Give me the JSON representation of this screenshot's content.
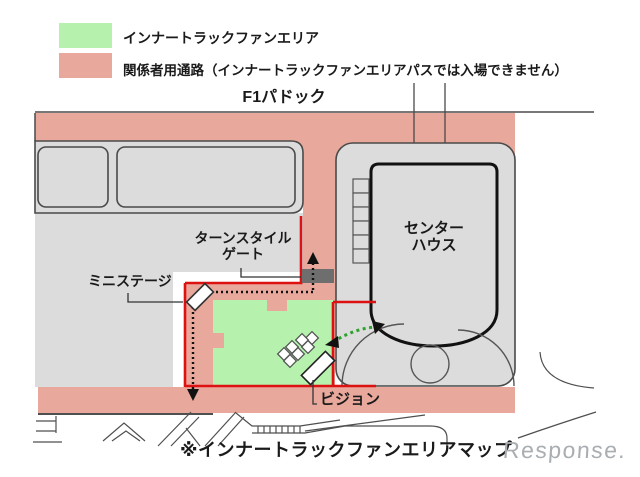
{
  "legend": {
    "items": [
      {
        "label": "インナートラックファンエリア",
        "color": "#b6f2ae"
      },
      {
        "label": "関係者用通路（インナートラックファンエリアパスでは入場できません）",
        "color": "#e9a89c"
      }
    ]
  },
  "map": {
    "title": "F1パドック",
    "labels": {
      "turnstile_line1": "ターンスタイル",
      "turnstile_line2": "ゲート",
      "mini_stage": "ミニステージ",
      "center_house_line1": "センター",
      "center_house_line2": "ハウス",
      "vision": "ビジョン"
    }
  },
  "caption": "※インナートラックファンエリアマップ",
  "watermark": "Response.",
  "colors": {
    "fan_area_green": "#b6f2ae",
    "corridor_salmon": "#e9a89c",
    "ground_gray": "#dcdcdc",
    "outline_dark": "#4a4a4a",
    "boundary_red": "#dd1111",
    "gate_gray": "#6e6e6e",
    "route_black": "#111111",
    "flow_arrow_green": "#2fa12f",
    "text_black": "#1a1a1a",
    "watermark_gray": "#a9aeb2"
  }
}
